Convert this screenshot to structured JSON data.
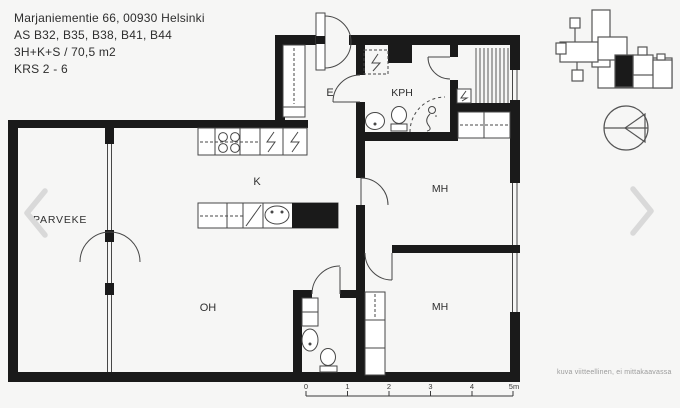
{
  "header": {
    "address": "Marjaniementie 66, 00930 Helsinki",
    "apartments": "AS B32, B35, B38, B41, B44",
    "layout": "3H+K+S / 70,5 m2",
    "floors": "KRS 2 - 6"
  },
  "floorplan": {
    "rooms": {
      "balcony": "PARVEKE",
      "entry": "E",
      "bathroom": "KPH",
      "kitchen": "K",
      "bedroom_top": "MH",
      "bedroom_bottom": "MH",
      "living_room": "OH"
    },
    "scale_bar": {
      "labels": [
        "0",
        "1",
        "2",
        "3",
        "4",
        "5m"
      ]
    },
    "disclaimer": "kuva viitteellinen, ei mittakaavassa"
  },
  "nav": {
    "prev_icon": "chevron-left",
    "next_icon": "chevron-right"
  },
  "colors": {
    "wall": "#1a1a1a",
    "line": "#474747",
    "chevron": "#d9d9d9",
    "text": "#2e2e2e",
    "muted_text": "#9b9b9b",
    "background": "#f6f6f5"
  }
}
